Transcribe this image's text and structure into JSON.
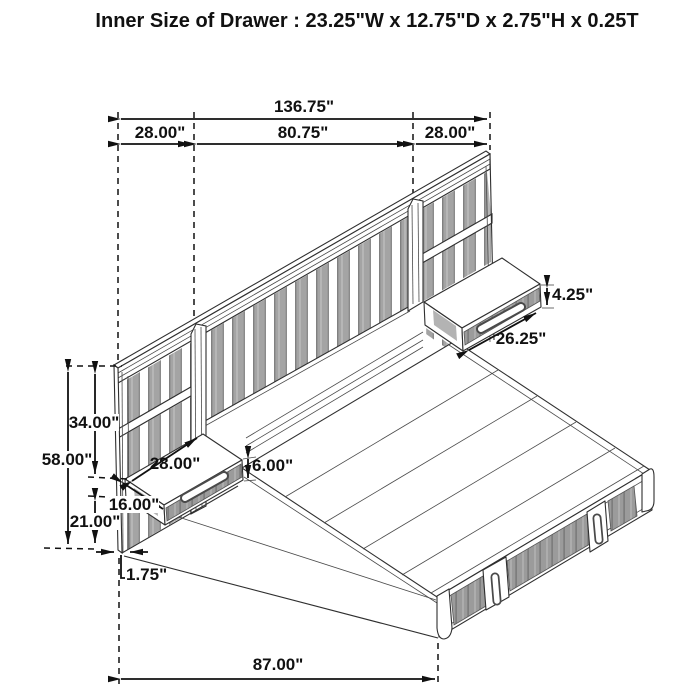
{
  "title": "Inner Size of Drawer : 23.25\"W x 12.75\"D x 2.75\"H x 0.25T",
  "dimensions": {
    "overall_width": "136.75\"",
    "left_panel_width": "28.00\"",
    "headboard_center_width": "80.75\"",
    "right_panel_width": "28.00\"",
    "right_nightstand_height": "4.25\"",
    "right_nightstand_width": "26.25\"",
    "panel_top_to_nightstand": "34.00\"",
    "panel_height": "58.00\"",
    "left_nightstand_width": "28.00\"",
    "left_nightstand_height": "6.00\"",
    "left_nightstand_depth": "16.00\"",
    "nightstand_to_floor": "21.00\"",
    "panel_thickness": "1.75\"",
    "platform_length": "87.00\""
  },
  "colors": {
    "line": "#222222",
    "slat_gray": "#a4a4a4",
    "drawer_gray": "#9b9b9b",
    "background": "#ffffff"
  }
}
